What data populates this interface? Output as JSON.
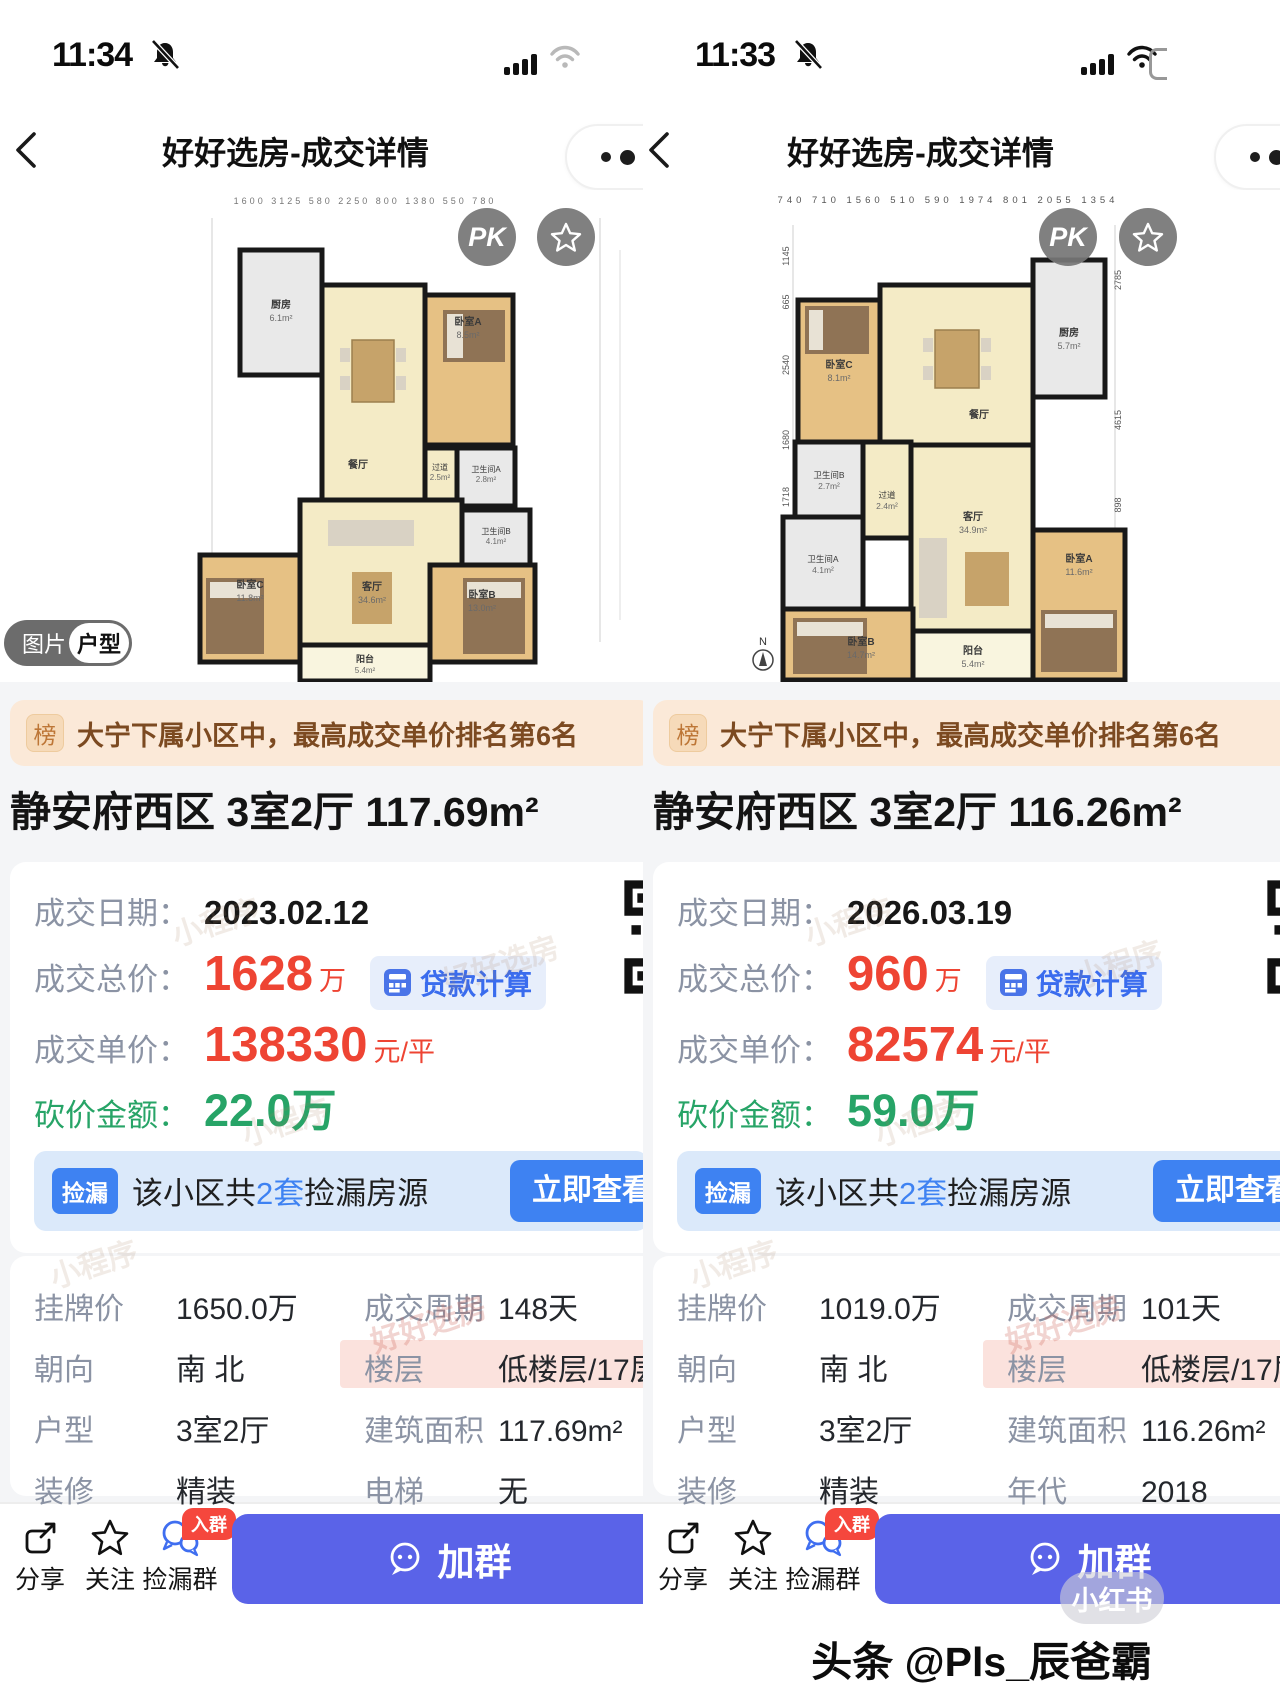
{
  "colors": {
    "price_red": "#ee4433",
    "deal_green": "#27a467",
    "link_blue": "#3e82f2",
    "join_indigo": "#5a63e8",
    "rank_peach": "#fbe9d8"
  },
  "watermarks": {
    "mini": "小程序",
    "brand": "好好选房"
  },
  "panels": [
    {
      "status": {
        "time": "11:34"
      },
      "nav": {
        "title": "好好选房-成交详情"
      },
      "plan": {
        "pk": "PK",
        "dims_top": "1600  3125  580  2250  800  1380  550  780",
        "rooms": {
          "kitchen": {
            "n": "厨房",
            "a": "6.1m²"
          },
          "dining": {
            "n": "餐厅",
            "a": ""
          },
          "bedA": {
            "n": "卧室A",
            "a": "8.5m²"
          },
          "hall": {
            "n": "过道",
            "a": "2.5m²"
          },
          "bathA": {
            "n": "卫生间A",
            "a": "2.8m²"
          },
          "bathB": {
            "n": "卫生间B",
            "a": "4.1m²"
          },
          "living": {
            "n": "客厅",
            "a": "34.6m²"
          },
          "bedC": {
            "n": "卧室C",
            "a": "11.8m²"
          },
          "bedB": {
            "n": "卧室B",
            "a": "13.0m²"
          },
          "balcony": {
            "n": "阳台",
            "a": "5.4m²"
          }
        }
      },
      "toggle": {
        "image": "图片",
        "plan": "户型"
      },
      "rank": {
        "badge": "榜",
        "text": "大宁下属小区中，最高成交单价排名第6名"
      },
      "title": "静安府西区 3室2厅 117.69m²",
      "deal": {
        "date_label": "成交日期：",
        "date": "2023.02.12",
        "total_label": "成交总价：",
        "total": "1628",
        "total_unit": "万",
        "loan": "贷款计算",
        "unit_label": "成交单价：",
        "unit": "138330",
        "unit_unit": "元/平",
        "cut_label": "砍价金额：",
        "cut": "22.0万"
      },
      "leak": {
        "badge": "捡漏",
        "pre": "该小区共",
        "count": "2套",
        "post": "捡漏房源",
        "btn": "立即查看"
      },
      "info": [
        {
          "l1": "挂牌价",
          "v1": "1650.0万",
          "l2": "成交周期",
          "v2": "148天"
        },
        {
          "l1": "朝向",
          "v1": "南 北",
          "l2": "楼层",
          "v2": "低楼层/17层"
        },
        {
          "l1": "户型",
          "v1": "3室2厅",
          "l2": "建筑面积",
          "v2": "117.69m²"
        },
        {
          "l1": "装修",
          "v1": "精装",
          "l2": "电梯",
          "v2": "无"
        }
      ],
      "tabbar": {
        "share": "分享",
        "follow": "关注",
        "group": "捡漏群",
        "badge": "入群",
        "join": "加群"
      }
    },
    {
      "status": {
        "time": "11:33"
      },
      "nav": {
        "title": "好好选房-成交详情"
      },
      "plan": {
        "pk": "PK",
        "dims_top": "740  710  1560  510  590  1974  801  2055  1354",
        "dims_left": [
          "1145",
          "665",
          "2540",
          "1680",
          "1718",
          "3242",
          "725",
          "785"
        ],
        "dims_right": [
          "2785",
          "4615",
          "898",
          "3052",
          "680"
        ],
        "compass": "N",
        "rooms": {
          "kitchen": {
            "n": "厨房",
            "a": "5.7m²"
          },
          "dining": {
            "n": "餐厅",
            "a": ""
          },
          "bedC": {
            "n": "卧室C",
            "a": "8.1m²"
          },
          "bathB": {
            "n": "卫生间B",
            "a": "2.7m²"
          },
          "hall": {
            "n": "过道",
            "a": "2.4m²"
          },
          "bathA": {
            "n": "卫生间A",
            "a": "4.1m²"
          },
          "living": {
            "n": "客厅",
            "a": "34.9m²"
          },
          "bedB": {
            "n": "卧室B",
            "a": "14.7m²"
          },
          "bedA": {
            "n": "卧室A",
            "a": "11.6m²"
          },
          "balcony": {
            "n": "阳台",
            "a": "5.4m²"
          }
        }
      },
      "rank": {
        "badge": "榜",
        "text": "大宁下属小区中，最高成交单价排名第6名"
      },
      "title": "静安府西区 3室2厅 116.26m²",
      "deal": {
        "date_label": "成交日期：",
        "date": "2026.03.19",
        "total_label": "成交总价：",
        "total": "960",
        "total_unit": "万",
        "loan": "贷款计算",
        "unit_label": "成交单价：",
        "unit": "82574",
        "unit_unit": "元/平",
        "cut_label": "砍价金额：",
        "cut": "59.0万"
      },
      "leak": {
        "badge": "捡漏",
        "pre": "该小区共",
        "count": "2套",
        "post": "捡漏房源",
        "btn": "立即查看"
      },
      "info": [
        {
          "l1": "挂牌价",
          "v1": "1019.0万",
          "l2": "成交周期",
          "v2": "101天"
        },
        {
          "l1": "朝向",
          "v1": "南 北",
          "l2": "楼层",
          "v2": "低楼层/17层"
        },
        {
          "l1": "户型",
          "v1": "3室2厅",
          "l2": "建筑面积",
          "v2": "116.26m²"
        },
        {
          "l1": "装修",
          "v1": "精装",
          "l2": "年代",
          "v2": "2018"
        }
      ],
      "tabbar": {
        "share": "分享",
        "follow": "关注",
        "group": "捡漏群",
        "badge": "入群",
        "join": "加群"
      },
      "footer": {
        "xhs": "小红书",
        "credit": "头条 @Pls_辰爸霸"
      }
    }
  ]
}
